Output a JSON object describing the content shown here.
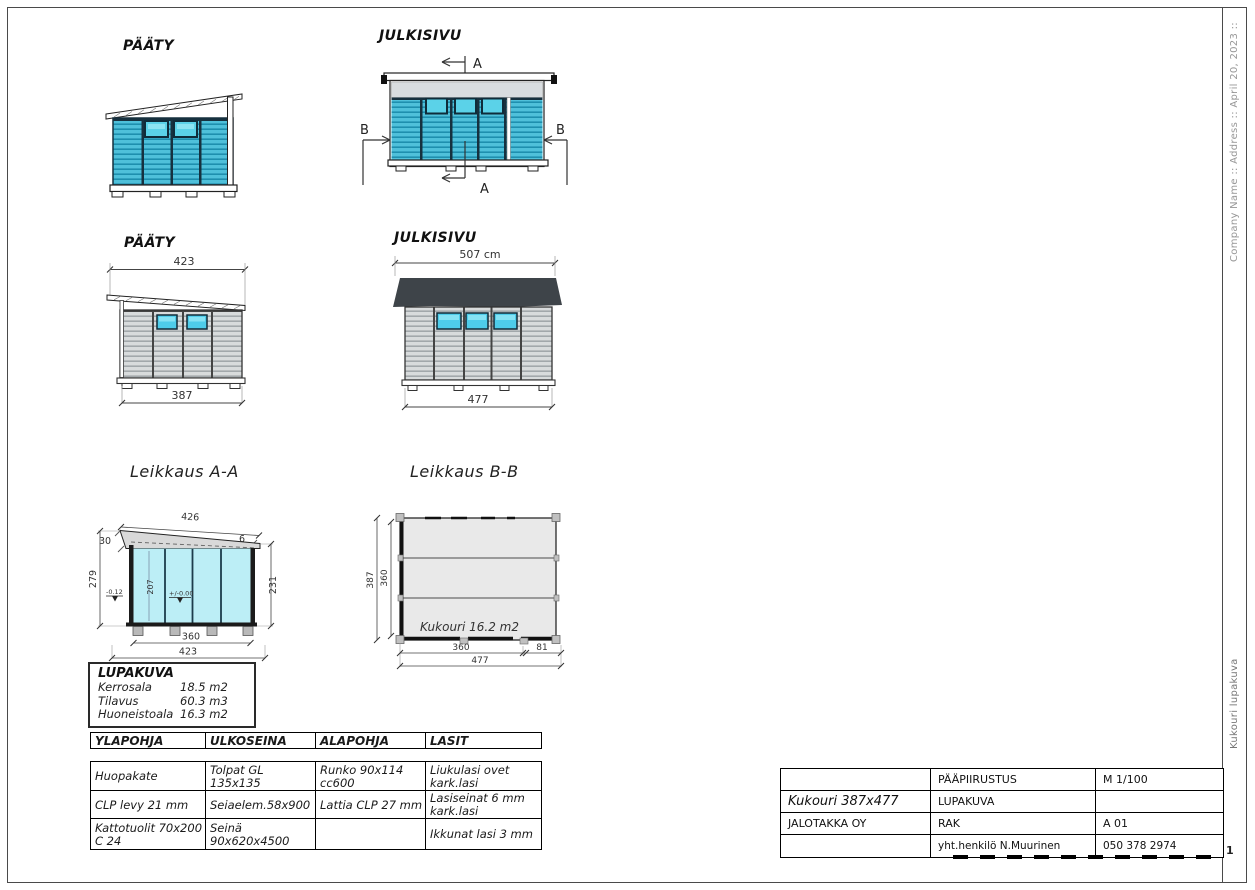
{
  "frame": {
    "company_sideline": "Company Name :: Address :: April 20, 2023 ::",
    "doc_sideline": "Kukouri lupakuva",
    "page_number": "1"
  },
  "views": {
    "paaty_top": {
      "label": "PÄÄTY"
    },
    "julkisivu_top": {
      "label": "JULKISIVU",
      "marker_a": "A",
      "marker_b": "B"
    },
    "paaty_dim": {
      "label": "PÄÄTY",
      "dim_top": "423",
      "dim_bottom": "387"
    },
    "julkisivu_dim": {
      "label": "JULKISIVU",
      "dim_top": "507 cm",
      "dim_bottom": "477"
    },
    "section_aa": {
      "label": "Leikkaus A-A",
      "dim_roof_slope": "426",
      "dim_left_overhang": "30",
      "dim_right_overhang": "6",
      "dim_left_height": "279",
      "dim_right_height": "231",
      "dim_inner_height": "207",
      "level_low": "-0.12",
      "level_zero": "+/-0.00",
      "dim_inner_width": "360",
      "dim_total_width": "423"
    },
    "section_bb": {
      "label": "Leikkaus B-B",
      "area_label": "Kukouri 16.2 m2",
      "dim_left_outer": "387",
      "dim_left_inner": "360",
      "dim_bottom_inner": "360",
      "dim_bottom_right": "81",
      "dim_bottom_total": "477"
    }
  },
  "lupakuva_box": {
    "title": "LUPAKUVA",
    "rows": [
      {
        "label": "Kerrosala",
        "value": "18.5 m2"
      },
      {
        "label": "Tilavus",
        "value": "60.3 m3"
      },
      {
        "label": "Huoneistoala",
        "value": "16.3 m2"
      }
    ]
  },
  "spec_table": {
    "headers": [
      "YLAPOHJA",
      "ULKOSEINA",
      "ALAPOHJA",
      "LASIT"
    ],
    "rows": [
      [
        "Huopakate",
        "Tolpat GL 135x135",
        "Runko 90x114 cc600",
        "Liukulasi ovet kark.lasi"
      ],
      [
        "CLP levy 21 mm",
        "Seiaelem.58x900",
        "Lattia CLP 27 mm",
        "Lasiseinat 6 mm kark.lasi"
      ],
      [
        "Kattotuolit 70x200 C 24",
        "Seinä 90x620x4500",
        "",
        "Ikkunat lasi 3 mm"
      ]
    ]
  },
  "title_block": {
    "rows": [
      [
        "",
        "PÄÄPIIRUSTUS",
        "M 1/100"
      ],
      [
        "Kukouri 387x477",
        "LUPAKUVA",
        ""
      ],
      [
        "JALOTAKKA OY",
        "RAK",
        "A 01"
      ],
      [
        "",
        "yht.henkilö N.Muurinen",
        "050 378 2974"
      ]
    ]
  }
}
